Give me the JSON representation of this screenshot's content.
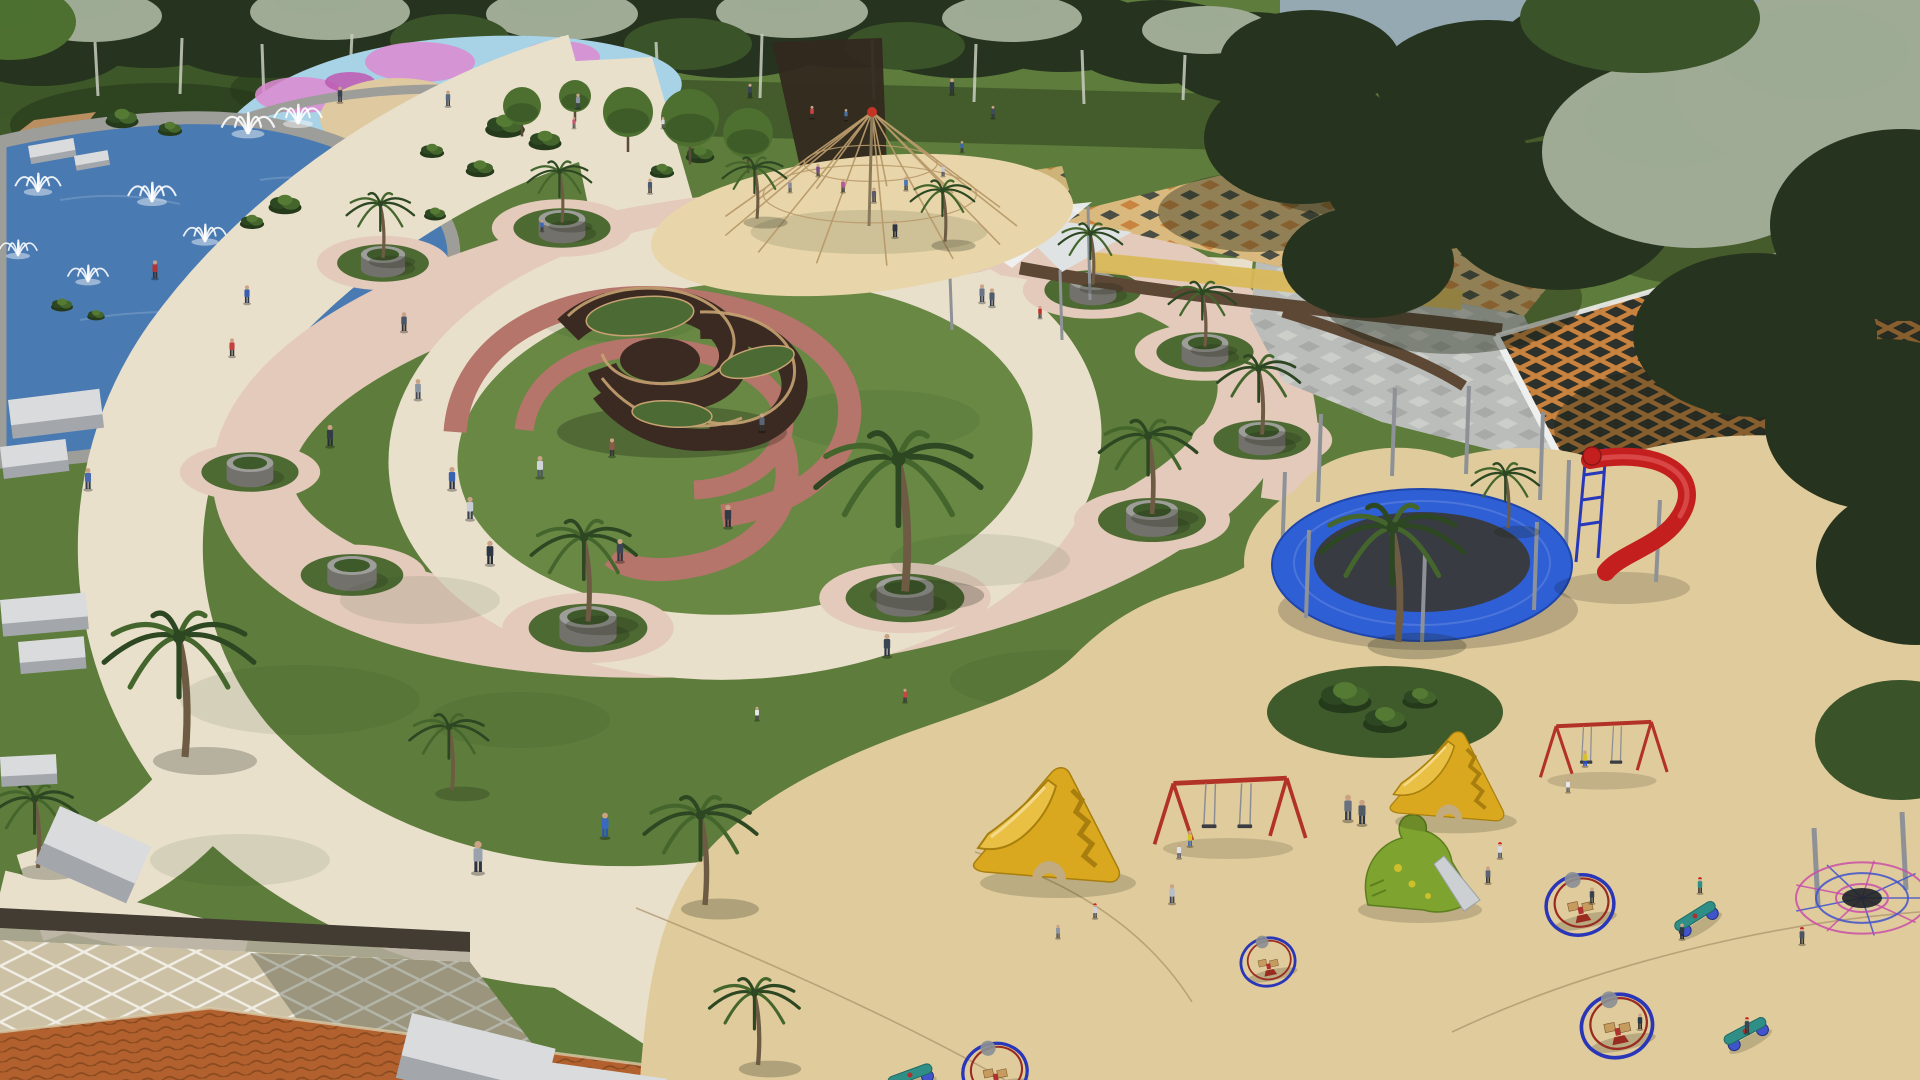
{
  "meta": {
    "description": "Aerial 3D render of a landscaped public park: fountain pool and splash pad (top left), circular central plaza with knot sculpture and red spiral paths, palm planters on a scalloped ring, rope-pyramid climber on a sand oval, checkered plaza with orange lattice shade canopy (right), and a large sand playground with trampoline, slides, swings and spinner rides (bottom right).",
    "width": 1920,
    "height": 1080
  },
  "palette": {
    "sky": "#94a9b1",
    "treeDark": "#26331e",
    "treeMid": "#3a5328",
    "treeSilver": "#9fab95",
    "treeBright": "#4d7030",
    "grass": "#5e7c3b",
    "grassLit": "#688844",
    "grassShade": "#41592b",
    "grassDark": "#2c401f",
    "nodeGrass": "#4e6a33",
    "water": "#4a7ab2",
    "waterLight": "#7da3cc",
    "stone": "#9d9d99",
    "stoneDark": "#73716b",
    "pathCream": "#e9e0cc",
    "pathCreamLit": "#f2ebda",
    "pathPink": "#e3cabb",
    "pathRose": "#d9bcae",
    "spiralRed": "#b5756a",
    "sand": "#e0cb9c",
    "sandLit": "#e8d6aa",
    "sandShade": "#c2ab7e",
    "sandSeam": "#a8906a",
    "sculptWall": "#3b2a21",
    "sculptEdge": "#c7a272",
    "sculptTop": "#4c6a33",
    "splashBlue": "#a8d2e6",
    "splashPink": "#db8bd0",
    "splashMagenta": "#bd5cb4",
    "splashPale": "#d2e9f2",
    "roofTile": "#b2612e",
    "roofLine": "#8a4a1f",
    "plazaDiamond": "#ccc1a5",
    "wallDark": "#433c33",
    "wallBrown": "#5d4836",
    "gravel": "#b5ad9e",
    "latticeOrange": "#c8823e",
    "latticeDark": "#2d312b",
    "checkTan": "#d9b97e",
    "checkOrange": "#c9853f",
    "checkDark": "#4a4e44",
    "plazaGray": "#babdb9",
    "plazaGrayLight": "#cbcec9",
    "plazaGrayDark": "#a7aaa6",
    "yellowBand": "#d9b85a",
    "canopyWhite": "#eef0f0",
    "pole": "#8e9297",
    "poleDark": "#6e7276",
    "tramRim": "#2e5fd4",
    "tramRimDark": "#1f46ad",
    "tramMat": "#383b41",
    "slideYellow": "#d9a81e",
    "slideYellowDark": "#a87f0e",
    "slideYellowLit": "#e9c043",
    "slideRed": "#c41f1f",
    "frameBlue": "#2739ba",
    "dinoGreen": "#7fa32f",
    "dinoDark": "#5c7f1e",
    "metal": "#ccd0d3",
    "swingRed": "#b23227",
    "chain": "#8a8e92",
    "seatDark": "#3a3e43",
    "spinnerBlue": "#2a36b8",
    "spinnerRed": "#992b20",
    "woodSeat": "#c59b5e",
    "teal": "#2f8f86",
    "palmTrunk": "#6e5b44",
    "palmFrond": "#2c4722",
    "palmFrondLight": "#44662d",
    "ropeTan": "#b99a6a",
    "ropeRed": "#c43526",
    "webPink": "#c84fa8",
    "webBlue": "#4054cc",
    "benchTop": "#d9dbdd",
    "benchSide": "#a3a7ac",
    "white": "#ffffff",
    "shadow": "#1a2412",
    "skin": "#caa385",
    "dirt": "#b98e60"
  },
  "treesBack": [
    [
      40,
      38,
      95,
      48,
      "treeDark"
    ],
    [
      150,
      26,
      100,
      42,
      "treeDark"
    ],
    [
      265,
      32,
      110,
      46,
      "treeDark"
    ],
    [
      380,
      22,
      100,
      42,
      "treeDark"
    ],
    [
      500,
      30,
      110,
      44,
      "treeDark"
    ],
    [
      618,
      24,
      100,
      40,
      "treeDark"
    ],
    [
      730,
      32,
      112,
      46,
      "treeDark"
    ],
    [
      848,
      26,
      106,
      42,
      "treeDark"
    ],
    [
      960,
      36,
      100,
      42,
      "treeDark"
    ],
    [
      1062,
      32,
      96,
      40,
      "treeDark"
    ],
    [
      1160,
      42,
      92,
      42,
      "treeDark"
    ],
    [
      1252,
      58,
      88,
      46,
      "treeDark"
    ],
    [
      92,
      16,
      70,
      26,
      "treeSilver"
    ],
    [
      330,
      12,
      80,
      28,
      "treeSilver"
    ],
    [
      562,
      14,
      76,
      26,
      "treeSilver"
    ],
    [
      792,
      12,
      76,
      26,
      "treeSilver"
    ],
    [
      1012,
      18,
      70,
      24,
      "treeSilver"
    ],
    [
      1206,
      30,
      64,
      24,
      "treeSilver"
    ],
    [
      10,
      22,
      66,
      38,
      "treeBright"
    ],
    [
      450,
      40,
      60,
      26,
      "treeMid"
    ],
    [
      688,
      44,
      64,
      26,
      "treeMid"
    ],
    [
      905,
      46,
      60,
      24,
      "treeMid"
    ]
  ],
  "treesFront": [
    [
      1310,
      60,
      90,
      50,
      "treeDark"
    ],
    [
      1302,
      138,
      98,
      66,
      "treeDark"
    ],
    [
      1432,
      178,
      108,
      72,
      "treeDark"
    ],
    [
      1368,
      262,
      86,
      56,
      "treeDark"
    ],
    [
      1560,
      215,
      115,
      75,
      "treeDark"
    ],
    [
      1488,
      82,
      112,
      62,
      "treeDark"
    ],
    [
      1622,
      62,
      132,
      72,
      "treeDark"
    ],
    [
      1694,
      152,
      152,
      96,
      "treeSilver"
    ],
    [
      1846,
      84,
      172,
      96,
      "treeSilver"
    ],
    [
      1902,
      225,
      132,
      96,
      "treeDark"
    ],
    [
      1755,
      335,
      122,
      82,
      "treeDark"
    ],
    [
      1885,
      425,
      120,
      86,
      "treeDark"
    ],
    [
      1916,
      565,
      100,
      80,
      "treeDark"
    ],
    [
      1640,
      18,
      120,
      55,
      "treeMid"
    ],
    [
      1900,
      740,
      85,
      60,
      "treeMid"
    ]
  ],
  "trunks": [
    [
      95,
      42,
      96,
      3
    ],
    [
      182,
      38,
      94,
      -2
    ],
    [
      262,
      44,
      100,
      2
    ],
    [
      352,
      34,
      96,
      -3
    ],
    [
      456,
      40,
      100,
      2
    ],
    [
      562,
      36,
      96,
      -2
    ],
    [
      656,
      42,
      100,
      3
    ],
    [
      762,
      34,
      98,
      -2
    ],
    [
      872,
      40,
      100,
      2
    ],
    [
      976,
      44,
      102,
      -2
    ],
    [
      1082,
      50,
      104,
      2
    ],
    [
      1185,
      55,
      100,
      -2
    ]
  ],
  "splashBlobs": [
    [
      300,
      95,
      45,
      18,
      "splashPink"
    ],
    [
      420,
      62,
      55,
      20,
      "splashPink"
    ],
    [
      560,
      57,
      40,
      16,
      "splashPink"
    ],
    [
      620,
      96,
      35,
      14,
      "splashPink"
    ],
    [
      480,
      120,
      50,
      16,
      "splashPink"
    ],
    [
      350,
      82,
      25,
      10,
      "splashMagenta"
    ],
    [
      590,
      76,
      22,
      9,
      "splashMagenta"
    ],
    [
      520,
      92,
      40,
      14,
      "splashPale"
    ]
  ],
  "fountains": [
    [
      248,
      132,
      1.1
    ],
    [
      298,
      122,
      1.0
    ],
    [
      152,
      200,
      1.0
    ],
    [
      38,
      190,
      0.95
    ],
    [
      18,
      254,
      0.8
    ],
    [
      88,
      280,
      0.85
    ],
    [
      205,
      240,
      0.9
    ]
  ],
  "planterNodes": [
    [
      383,
      263,
      0.85,
      1,
      0.9
    ],
    [
      562,
      228,
      0.9,
      1,
      0.85
    ],
    [
      757,
      224,
      0.9,
      1,
      0.85
    ],
    [
      945,
      247,
      0.9,
      1,
      0.85
    ],
    [
      1093,
      290,
      0.9,
      1,
      0.85
    ],
    [
      1205,
      352,
      0.9,
      1,
      0.9
    ],
    [
      1262,
      440,
      0.9,
      1,
      1.1
    ],
    [
      1152,
      520,
      1.0,
      1,
      1.3
    ],
    [
      905,
      598,
      1.1,
      1,
      2.2
    ],
    [
      588,
      628,
      1.1,
      1,
      1.4
    ],
    [
      352,
      575,
      0.95,
      0,
      0
    ],
    [
      250,
      472,
      0.9,
      0,
      0
    ]
  ],
  "palms": [
    [
      185,
      757,
      2.0
    ],
    [
      38,
      868,
      1.15
    ],
    [
      452,
      790,
      1.05
    ],
    [
      705,
      905,
      1.5
    ],
    [
      758,
      1065,
      1.2
    ],
    [
      1652,
      138,
      0.95
    ],
    [
      1895,
      565,
      1.5
    ],
    [
      1398,
      642,
      1.9
    ],
    [
      1508,
      528,
      0.9
    ]
  ],
  "shrubs": [
    [
      505,
      128,
      0.9
    ],
    [
      545,
      142,
      0.75
    ],
    [
      480,
      170,
      0.65
    ],
    [
      432,
      152,
      0.55
    ],
    [
      285,
      206,
      0.75
    ],
    [
      252,
      223,
      0.55
    ],
    [
      700,
      156,
      0.65
    ],
    [
      662,
      172,
      0.55
    ],
    [
      122,
      120,
      0.75
    ],
    [
      170,
      130,
      0.55
    ],
    [
      62,
      306,
      0.5
    ],
    [
      96,
      316,
      0.4
    ],
    [
      435,
      215,
      0.5
    ],
    [
      1345,
      700,
      1.2
    ],
    [
      1385,
      722,
      1.0
    ],
    [
      1420,
      700,
      0.8
    ]
  ],
  "roundTrees": [
    [
      628,
      112,
      25
    ],
    [
      690,
      118,
      29
    ],
    [
      748,
      133,
      25
    ],
    [
      522,
      106,
      19
    ],
    [
      575,
      96,
      16
    ]
  ],
  "benches": [
    [
      8,
      400,
      92,
      34,
      -7
    ],
    [
      0,
      447,
      66,
      28,
      -7
    ],
    [
      0,
      600,
      86,
      32,
      -5
    ],
    [
      18,
      642,
      66,
      28,
      -5
    ],
    [
      0,
      757,
      56,
      26,
      -3
    ],
    [
      60,
      806,
      100,
      54,
      24
    ],
    [
      412,
      1013,
      148,
      58,
      14
    ],
    [
      548,
      1062,
      120,
      36,
      8
    ],
    [
      28,
      146,
      46,
      16,
      -10
    ],
    [
      74,
      156,
      34,
      13,
      -10
    ]
  ],
  "ropePyramid": {
    "apex": [
      872,
      112
    ],
    "base": [
      869,
      226
    ],
    "rx": 148,
    "ry": 40,
    "ropes": 13
  },
  "spiderWeb": {
    "cx": 1862,
    "cy": 898,
    "poles": [
      [
        1814,
        828,
        906
      ],
      [
        1902,
        812,
        890
      ],
      [
        1946,
        854,
        942
      ]
    ],
    "rings": [
      26,
      46,
      66
    ],
    "radials": 9
  },
  "yellowSlides": [
    [
      1053,
      845,
      1.0
    ],
    [
      1452,
      792,
      0.78
    ]
  ],
  "swings": [
    [
      1228,
      838,
      1.05
    ],
    [
      1602,
      772,
      0.88
    ]
  ],
  "spinners": [
    [
      1580,
      905,
      1.0
    ],
    [
      1617,
      1026,
      1.05
    ],
    [
      995,
      1072,
      0.95
    ],
    [
      1268,
      962,
      0.8
    ]
  ],
  "springRiders": [
    [
      1695,
      916,
      -32
    ],
    [
      1745,
      1031,
      -28
    ],
    [
      910,
      1075,
      -20
    ]
  ],
  "people": [
    [
      340,
      102,
      0.7,
      "#3a4250",
      "#2b3340",
      null
    ],
    [
      448,
      106,
      0.7,
      "#5a6a80",
      "#333a46",
      null
    ],
    [
      578,
      108,
      0.65,
      "#8a93a0",
      "#3a4250",
      null
    ],
    [
      574,
      128,
      0.5,
      "#c05a70",
      "#444444",
      null
    ],
    [
      750,
      97,
      0.6,
      "#394455",
      "#222c38",
      null
    ],
    [
      952,
      94,
      0.7,
      "#2e3844",
      "#242e3a",
      null
    ],
    [
      993,
      118,
      0.55,
      "#3f4c5e",
      "#2c3542",
      null
    ],
    [
      812,
      118,
      0.55,
      "#cc4444",
      "#333333",
      null
    ],
    [
      846,
      120,
      0.5,
      "#4a6fa5",
      "#333333",
      null
    ],
    [
      663,
      128,
      0.5,
      "#d8d8e0",
      "#555555",
      null
    ],
    [
      818,
      176,
      0.55,
      "#7a4a8a",
      "#333333",
      null
    ],
    [
      843,
      192,
      0.6,
      "#b05a9a",
      "#333333",
      null
    ],
    [
      874,
      202,
      0.65,
      "#5a5a6a",
      "#2e2e3a",
      null
    ],
    [
      906,
      190,
      0.6,
      "#4a78b8",
      "#333333",
      null
    ],
    [
      943,
      176,
      0.55,
      "#c8c8d0",
      "#444444",
      null
    ],
    [
      962,
      152,
      0.5,
      "#3a68b0",
      "#333333",
      null
    ],
    [
      790,
      192,
      0.55,
      "#8888a0",
      "#444444",
      null
    ],
    [
      895,
      237,
      0.75,
      "#2e3440",
      "#232830",
      null
    ],
    [
      650,
      193,
      0.65,
      "#4a5a70",
      "#333333",
      null
    ],
    [
      982,
      302,
      0.8,
      "#6a7485",
      "#3a4150",
      null
    ],
    [
      992,
      306,
      0.8,
      "#525c6e",
      "#333c4a",
      null
    ],
    [
      1040,
      318,
      0.55,
      "#c03030",
      "#333333",
      null
    ],
    [
      155,
      278,
      0.8,
      "#b03636",
      "#333333",
      null
    ],
    [
      247,
      303,
      0.8,
      "#3a5fae",
      "#2e3848",
      null
    ],
    [
      232,
      356,
      0.8,
      "#c24040",
      "#333333",
      null
    ],
    [
      330,
      446,
      0.95,
      "#343c48",
      "#262c36",
      null
    ],
    [
      418,
      399,
      0.9,
      "#8a94a2",
      "#3e4654",
      null
    ],
    [
      404,
      331,
      0.85,
      "#4a5565",
      "#333333",
      null
    ],
    [
      452,
      489,
      1.0,
      "#3a62b2",
      "#2c3440",
      null
    ],
    [
      470,
      519,
      1.0,
      "#c8ccd4",
      "#3a4250",
      null
    ],
    [
      490,
      564,
      1.05,
      "#2e3744",
      "#232a34",
      null
    ],
    [
      540,
      477,
      0.95,
      "#d0d4da",
      "#4a5565",
      null
    ],
    [
      620,
      561,
      1.0,
      "#3c4553",
      "#2b323e",
      null
    ],
    [
      728,
      527,
      1.0,
      "#323a46",
      "#262c36",
      null
    ],
    [
      762,
      431,
      0.8,
      "#5a6476",
      "#333333",
      null
    ],
    [
      612,
      456,
      0.8,
      "#8a5a4a",
      "#333333",
      null
    ],
    [
      88,
      489,
      0.95,
      "#4a6ab0",
      "#333c48",
      null
    ],
    [
      542,
      231,
      0.5,
      "#3a66bb",
      "#333333",
      null
    ],
    [
      887,
      656,
      1.0,
      "#3a4554",
      "#2c3442",
      null
    ],
    [
      478,
      872,
      1.4,
      "#9aa2ae",
      "#2e3540",
      null
    ],
    [
      605,
      837,
      1.1,
      "#3a6ac0",
      "#2a5aa8",
      null
    ],
    [
      1348,
      820,
      1.15,
      "#6a7280",
      "#3a424e",
      null
    ],
    [
      1362,
      824,
      1.1,
      "#525a68",
      "#2e3540",
      null
    ],
    [
      1500,
      858,
      0.7,
      "#d8d8e0",
      "#445566",
      "#cc2222"
    ],
    [
      1488,
      883,
      0.75,
      "#5a6474",
      "#333333",
      null
    ],
    [
      1190,
      846,
      0.7,
      "#d8c22a",
      "#3a62b2",
      null
    ],
    [
      1179,
      858,
      0.65,
      "#e0e0e8",
      "#555566",
      null
    ],
    [
      1172,
      903,
      0.85,
      "#b8bec8",
      "#3a4452",
      null
    ],
    [
      1095,
      918,
      0.65,
      "#d0d0d8",
      "#444444",
      "#cc2222"
    ],
    [
      1058,
      938,
      0.6,
      "#8a94a4",
      "#444444",
      null
    ],
    [
      1585,
      766,
      0.7,
      "#d8c22a",
      "#2a52c8",
      null
    ],
    [
      1568,
      792,
      0.6,
      "#e8e8f0",
      "#555555",
      null
    ],
    [
      1592,
      903,
      0.7,
      "#3a4250",
      "#2a3240",
      null
    ],
    [
      1640,
      1029,
      0.7,
      "#2a3a4a",
      "#222222",
      null
    ],
    [
      1700,
      893,
      0.7,
      "#2f8f86",
      "#333333",
      "#cc2222"
    ],
    [
      1747,
      1033,
      0.7,
      "#3a4454",
      "#333333",
      "#cc2222"
    ],
    [
      1802,
      944,
      0.75,
      "#4a5565",
      "#333333",
      "#cc2222"
    ],
    [
      1682,
      939,
      0.7,
      "#2e3844",
      "#222222",
      null
    ],
    [
      905,
      702,
      0.6,
      "#cc4444",
      "#333333",
      null
    ],
    [
      757,
      720,
      0.6,
      "#e8e8f0",
      "#444444",
      null
    ]
  ],
  "grassBlotches": [
    [
      300,
      700,
      120,
      35
    ],
    [
      520,
      720,
      90,
      28
    ],
    [
      880,
      420,
      100,
      30
    ],
    [
      420,
      600,
      80,
      24
    ],
    [
      980,
      560,
      90,
      26
    ],
    [
      620,
      320,
      80,
      22
    ],
    [
      1060,
      680,
      110,
      30
    ],
    [
      240,
      860,
      90,
      26
    ]
  ],
  "treeShadows": [
    [
      1452,
      298,
      130,
      56
    ],
    [
      1704,
      428,
      150,
      66
    ],
    [
      1848,
      332,
      140,
      60
    ],
    [
      1258,
      212,
      100,
      40
    ],
    [
      1600,
      122,
      150,
      55
    ],
    [
      1340,
      170,
      90,
      45
    ],
    [
      1700,
      230,
      120,
      55
    ]
  ]
}
